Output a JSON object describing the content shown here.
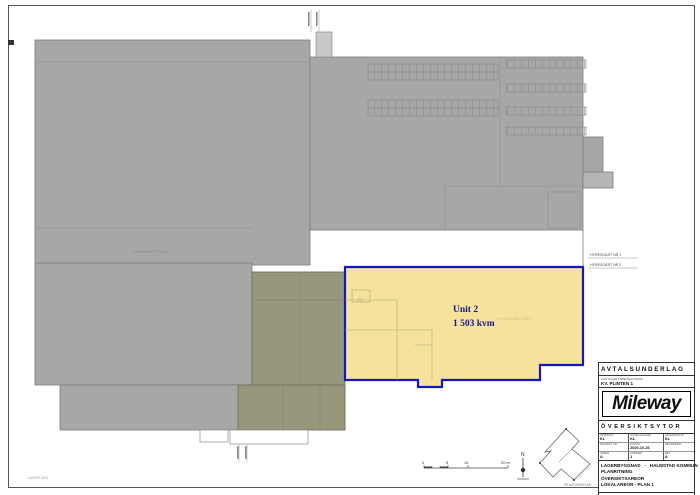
{
  "sheet": {
    "corner_note": "LAGER 2011"
  },
  "plan": {
    "unit_label": {
      "line1": "Unit 2",
      "line2": "1 503 kvm"
    },
    "tenant_area1": "HYRESGÄST NR 1",
    "tenant_area2": "HYRESGÄST NR 2",
    "legend_row1": "HYRESGÄST NR 1",
    "legend_row2": "HYRESGÄST NR 2",
    "scalebar": {
      "t0": "0",
      "t1": "5",
      "t2": "10",
      "t3": "20 m"
    },
    "north_label": "N",
    "keyplan_caption": "SITUATIONSPLAN"
  },
  "titleblock": {
    "doc_type": "AVTALSUNDERLAG",
    "property_label": "FASTIGHETSBETECKNING",
    "property_value": "KV. PLINTEN 1",
    "logo": "Mileway",
    "section_title": "ÖVERSIKTSYTOR",
    "grid": {
      "r1": [
        {
          "label": "UPPDRAG",
          "value": "KL"
        },
        {
          "label": "HANDLÄGGARE",
          "value": "KL"
        },
        {
          "label": "GRANSKAD AV",
          "value": "KL"
        }
      ],
      "r2": [
        {
          "label": "PROJEKT NR",
          "value": ""
        },
        {
          "label": "DATUM",
          "value": "2020-10-26"
        },
        {
          "label": "REVIDERING",
          "value": ""
        }
      ],
      "r3": [
        {
          "label": "SKEDE",
          "value": "A"
        },
        {
          "label": "NUMMER",
          "value": "1"
        },
        {
          "label": "BET",
          "value": "A"
        }
      ]
    },
    "description": [
      "LAGERBYGGNAD   -   HALMSTAD KOMMUN",
      "PLANRITNING",
      "ÖVERSIKTSAREOR",
      "LOKALAREOR - PLAN 1"
    ],
    "scale_label": "SKALA A1 (A3)",
    "scale_value": "1:200 (A1), 1:400 (A3)"
  },
  "colors": {
    "building_gray": "#a7a7a7",
    "annex_olive": "#98977c",
    "unit_fill": "#f5e29b",
    "unit_border": "#1616bd",
    "unit_text": "#16168c"
  }
}
